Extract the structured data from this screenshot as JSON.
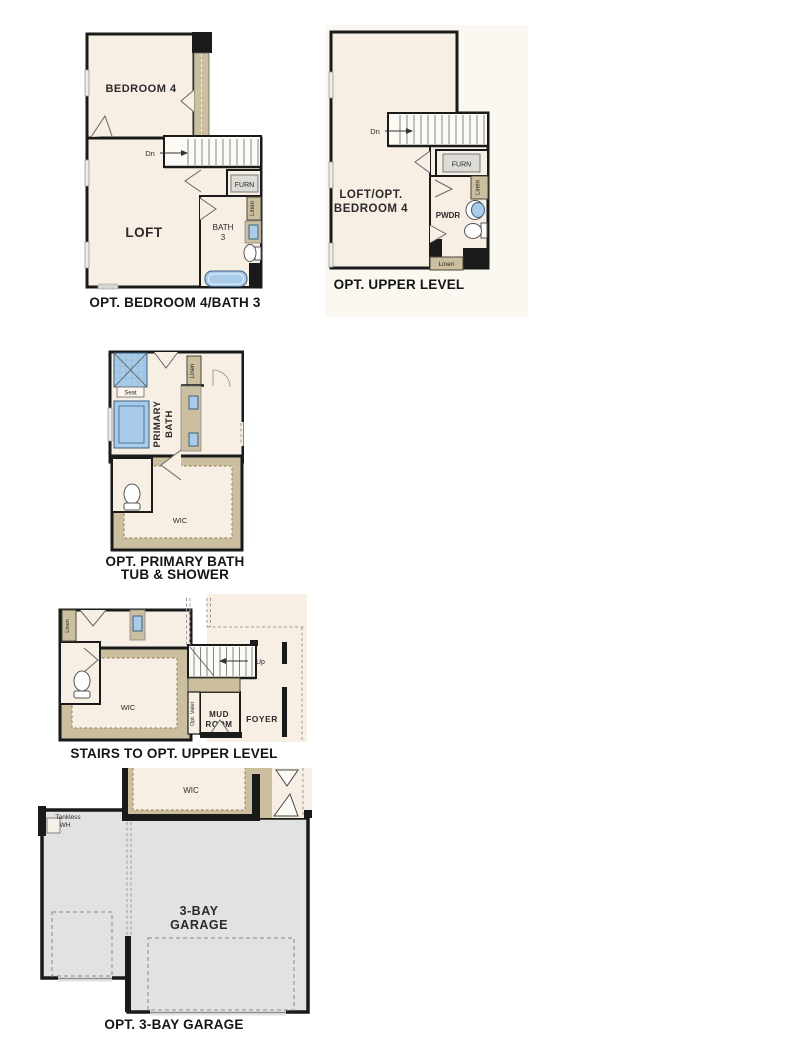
{
  "colors": {
    "background": "#ffffff",
    "room_interior": "#F7EFE4",
    "wall": "#1a1a1a",
    "carpet_tan": "#CBBF9F",
    "fixture_blue": "#A8CBE9",
    "garage_gray": "#E2E2E1"
  },
  "plans": {
    "p1": {
      "caption": "OPT. BEDROOM 4/BATH 3",
      "bedroom": "BEDROOM 4",
      "loft": "LOFT",
      "dn": "Dn",
      "furn": "FURN",
      "linen": "Linen",
      "bath1": "BATH",
      "bath2": "3"
    },
    "p2": {
      "caption": "OPT. UPPER LEVEL",
      "room1": "LOFT/OPT.",
      "room2": "BEDROOM 4",
      "dn": "Dn",
      "furn": "FURN",
      "linen_side": "Linen",
      "linen_bottom": "Linen",
      "pwdr": "PWDR"
    },
    "p3": {
      "caption1": "OPT. PRIMARY BATH",
      "caption2": "TUB & SHOWER",
      "primary1": "PRIMARY",
      "primary2": "BATH",
      "seat": "Seat",
      "linen": "Linen",
      "wic": "WIC"
    },
    "p4": {
      "caption": "STAIRS TO OPT. UPPER LEVEL",
      "wic": "WIC",
      "up": "Up",
      "linen": "Linen",
      "valet": "Opt. Valet",
      "mud1": "MUD",
      "mud2": "ROOM",
      "foyer": "FOYER"
    },
    "p5": {
      "caption": "OPT. 3-BAY GARAGE",
      "wic": "WIC",
      "g1": "3-BAY",
      "g2": "GARAGE",
      "t1": "Tankless",
      "t2": "WH"
    }
  }
}
